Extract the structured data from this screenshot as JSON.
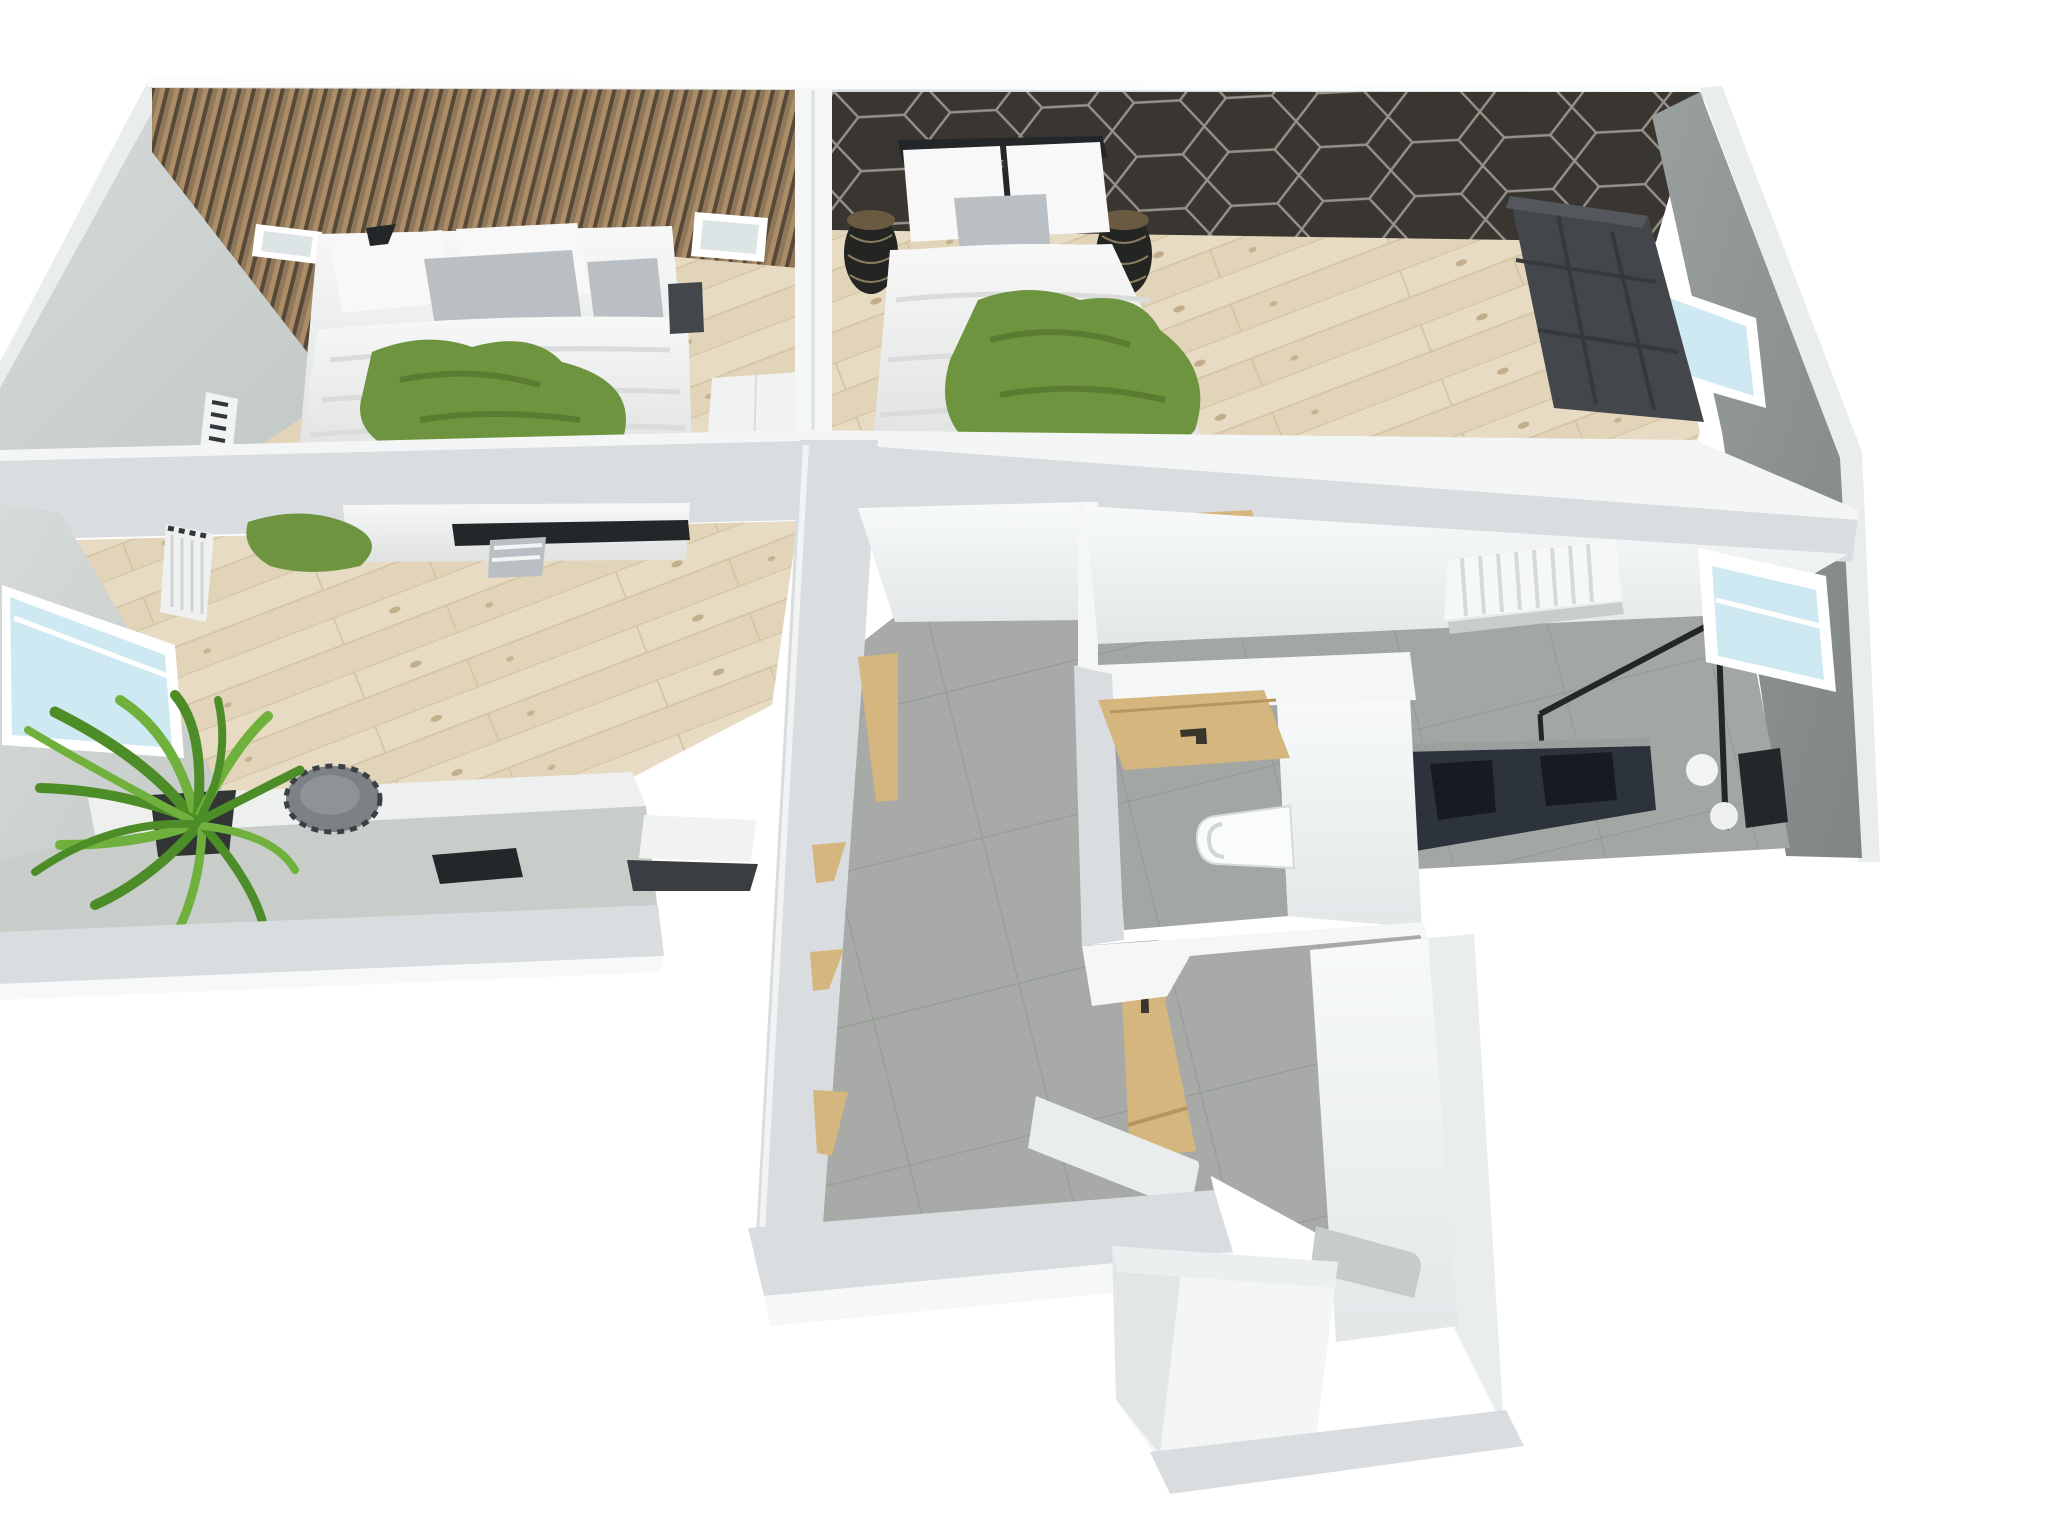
{
  "meta": {
    "title": "3D cutaway floor-plan rendering of an apartment upper floor",
    "view": "isometric top-down dollhouse render",
    "background": "#ffffff",
    "visible_text": "none"
  },
  "palette": {
    "bg": "#ffffff",
    "wall-outer": "#e9edee",
    "wall-band": "#d9dde0",
    "wall-bright": "#f5f7f7",
    "wall-grey": "#c9cfcd",
    "wall-grey2": "#9aa09f",
    "concrete": "#8e9492",
    "slat-mid": "#8f775a",
    "slat-dark": "#574838",
    "slat-light": "#ab8e68",
    "hex-base": "#393530",
    "hex-line": "#97918a",
    "floor-wood": "#e7dbc3",
    "floor-wood-line": "#d2c2a4",
    "floor-tile": "#a7aaa6",
    "bath-floor": "#a3a7a3",
    "bed-white": "#f0f2f1",
    "pillow": "#f7f8f7",
    "cushion": "#b9bfc3",
    "green": "#6f9440",
    "green-dark": "#55762c",
    "plant": "#4c8d27",
    "plant-light": "#6fb13c",
    "pot": "#313634",
    "wood-door": "#d5b67e",
    "wood-door-dark": "#b8955f",
    "handle": "#3a352c",
    "wardrobe-dark": "#43474c",
    "vanity": "#2d333c",
    "vanity-dark": "#171b21",
    "glass": "#cfe9f2",
    "frame": "#ffffff",
    "toilet": "#fafbfb",
    "dark": "#23272a"
  },
  "scene": {
    "rooms": [
      {
        "id": "bedroom-1",
        "objects": [
          "wood-slat-accent-wall",
          "skylight-window",
          "skylight-window",
          "double-bed",
          "green-throw-blanket",
          "grey-cushions",
          "bedside-table",
          "white-wardrobe",
          "radiator",
          "side-window",
          "roller-blind-radiator",
          "desk-counter",
          "laptop",
          "round-stool",
          "potted-plant"
        ]
      },
      {
        "id": "bedroom-2",
        "objects": [
          "hexagon-accent-wall",
          "double-bed",
          "green-throw-blanket",
          "wire-basket-side-table",
          "wire-basket-side-table",
          "pendant-lamp",
          "corner-sofa",
          "east-window"
        ]
      },
      {
        "id": "hallway",
        "objects": [
          "tiled-floor",
          "open-wood-door",
          "door-frame-trims"
        ]
      },
      {
        "id": "wc",
        "objects": [
          "wood-door",
          "wall-hung-toilet",
          "tiled-floor"
        ]
      },
      {
        "id": "bathroom",
        "objects": [
          "towel-radiator",
          "walk-in-shower-black-frame",
          "double-vanity-dark",
          "bath-mat",
          "wall-lights",
          "east-window",
          "tiled-floor"
        ]
      },
      {
        "id": "stair-landing",
        "objects": [
          "closed-wood-door",
          "tiled-floor",
          "white-landing",
          "step"
        ]
      }
    ]
  }
}
